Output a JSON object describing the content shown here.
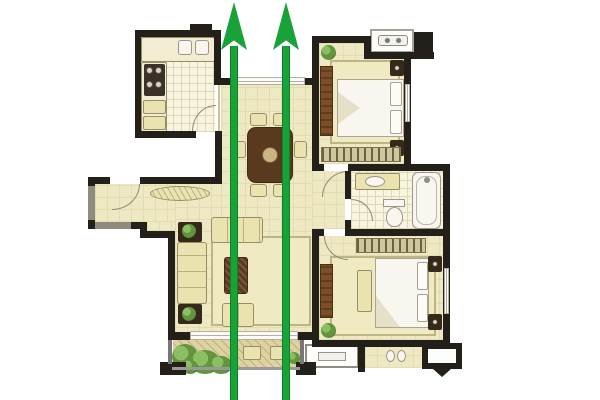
{
  "figure": {
    "title": "Apartment floor plan with through-draft arrows",
    "type": "floor-plan-diagram",
    "description": "Colored architectural floor plan of a two-bedroom apartment on a white background. Two large green arrows run vertically from the bottom balcony straight through the living-dining area and out of the front window, indicating a straight through-draft path.",
    "canvas": {
      "width": 600,
      "height": 400
    }
  },
  "colors": {
    "background": "#ffffff",
    "wall": "#23201a",
    "wall-gray": "#8f8b7f",
    "floor": "#efe9c3",
    "floor-line": "#e3dcb3",
    "tile": "#f7f4df",
    "tile-line": "#ded8b6",
    "furniture": "#eae3b0",
    "furniture-border": "#978e66",
    "wood": "#7d4f28",
    "wood-dark": "#5a3a1e",
    "dark-fixture": "#352a1a",
    "white-fixture": "#f8f6ee",
    "fixture-border": "#9a968a",
    "rug": "#f0eac2",
    "rug-border": "#bdb584",
    "hatch": "#cfc79c",
    "hatch-mark": "#6b6246",
    "plant": "#63953f",
    "plant-dark": "#41702c",
    "balcony-floor": "#ded2a3",
    "window": "#fbfaf4",
    "arrow": "#18a238",
    "arrow-dark": "#0d8126"
  },
  "arrows": [
    {
      "id": "draft-arrow-left",
      "direction": "up",
      "label": "draft-direction-arrow"
    },
    {
      "id": "draft-arrow-right",
      "direction": "up",
      "label": "draft-direction-arrow"
    }
  ],
  "rooms": [
    {
      "id": "kitchen",
      "furniture": [
        "counter",
        "double-sink",
        "cooktop",
        "cabinets",
        "door-arc"
      ]
    },
    {
      "id": "entry-hall",
      "furniture": [
        "entry-door-arc",
        "console-table"
      ]
    },
    {
      "id": "dining-area",
      "furniture": [
        "dining-table",
        "six-chairs",
        "front-window"
      ]
    },
    {
      "id": "bedroom-upper",
      "furniture": [
        "double-bed",
        "pillows",
        "nightstands",
        "wardrobe",
        "closet-hatch",
        "rug",
        "plant",
        "window"
      ]
    },
    {
      "id": "bathroom",
      "furniture": [
        "vanity-sink",
        "toilet",
        "bathtub",
        "door-arc"
      ]
    },
    {
      "id": "living-room",
      "furniture": [
        "long-sofa",
        "loveseat",
        "armchair",
        "coffee-table",
        "side-tables",
        "plants",
        "rug",
        "balcony-window"
      ]
    },
    {
      "id": "master-bedroom",
      "furniture": [
        "double-bed",
        "pillows",
        "nightstands",
        "bench",
        "cabinet",
        "closet-hatch",
        "rug",
        "plant",
        "window"
      ]
    },
    {
      "id": "balcony",
      "furniture": [
        "plants",
        "stools"
      ]
    },
    {
      "id": "rear-balcony",
      "furniture": [
        "platform-box",
        "slippers"
      ]
    },
    {
      "id": "ac-platform-top",
      "furniture": [
        "ac-unit-glyph"
      ]
    },
    {
      "id": "ac-platform-bottom",
      "furniture": []
    }
  ]
}
